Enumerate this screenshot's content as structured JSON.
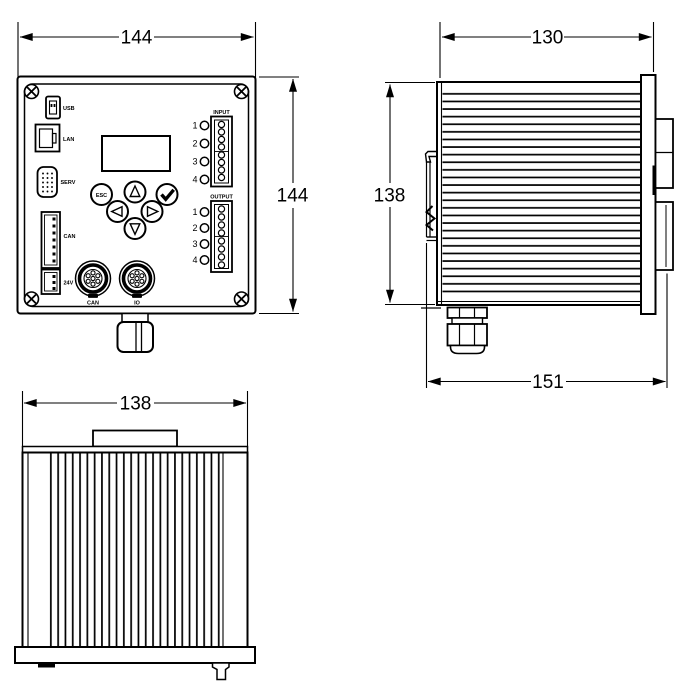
{
  "dimensions": {
    "front_width": "144",
    "front_height": "144",
    "side_width": "130",
    "side_height": "138",
    "side_depth": "151",
    "bottom_width": "138"
  },
  "front_panel": {
    "port_labels": {
      "usb": "USB",
      "lan": "LAN",
      "serv": "SERV",
      "can": "CAN",
      "power": "24V"
    },
    "buttons": {
      "esc": "ESC"
    },
    "input": {
      "label": "INPUT",
      "channels": [
        "1",
        "2",
        "3",
        "4"
      ]
    },
    "output": {
      "label": "OUTPUT",
      "channels": [
        "1",
        "2",
        "3",
        "4"
      ]
    },
    "round_connectors": {
      "left": "CAN",
      "right": "IO"
    }
  },
  "colors": {
    "line": "#000000",
    "background": "#ffffff"
  }
}
